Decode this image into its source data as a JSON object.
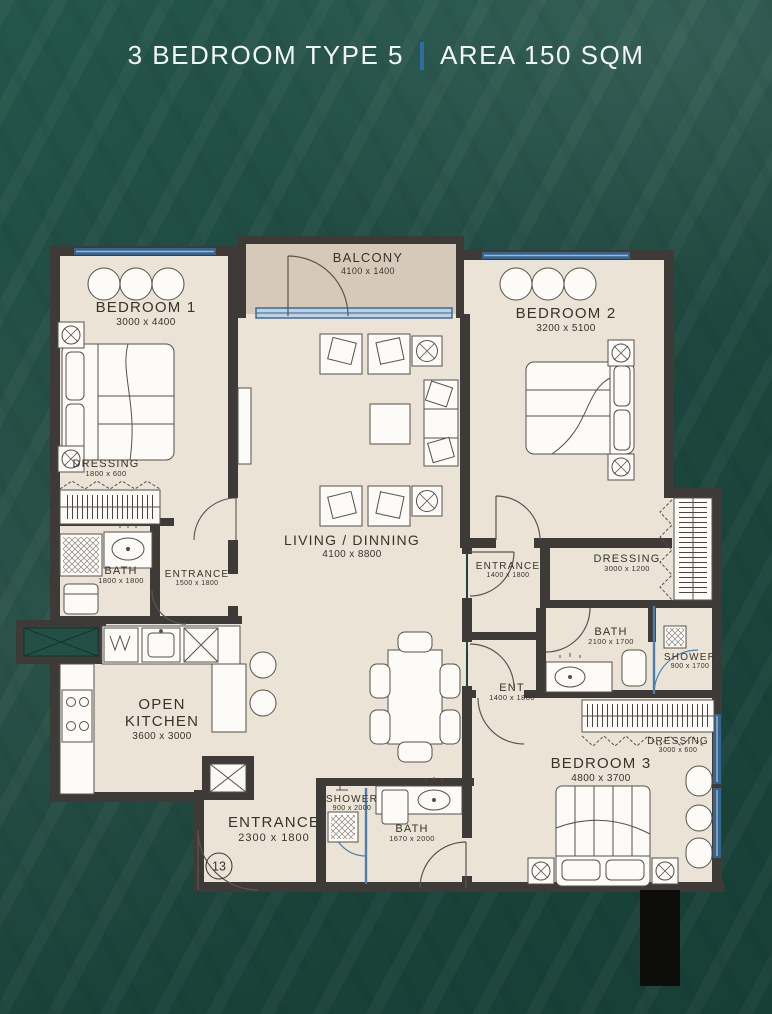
{
  "title": {
    "left": "3 BEDROOM TYPE 5",
    "divider": "|",
    "right": "AREA 150 SQM"
  },
  "unit_number": "13",
  "colors": {
    "background_green": "#1e483f",
    "title_text": "#f3f5f4",
    "title_divider_blue": "#2e6d9c",
    "floor_beige": "#ebe3d5",
    "balcony_floor": "#d7c9ba",
    "wall_dark": "#3e3a37",
    "window_blue": "#35648e",
    "glass_blue": "#4d7fae",
    "label_text": "#38332d",
    "shaft_black": "#0d0d0c"
  },
  "rooms": {
    "balcony": {
      "name": "BALCONY",
      "dims": "4100 x 1400"
    },
    "bedroom1": {
      "name": "BEDROOM 1",
      "dims": "3000 x 4400"
    },
    "bedroom2": {
      "name": "BEDROOM 2",
      "dims": "3200 x 5100"
    },
    "living": {
      "name": "LIVING / DINNING",
      "dims": "4100 x 8800"
    },
    "dressing1": {
      "name": "DRESSING",
      "dims": "1800 x 600"
    },
    "bath1": {
      "name": "BATH",
      "dims": "1800 x 1800"
    },
    "entrance1": {
      "name": "ENTRANCE",
      "dims": "1500 x 1800"
    },
    "kitchen": {
      "name": "OPEN KITCHEN",
      "dims": "3600 x 3000"
    },
    "entrance_main": {
      "name": "ENTRANCE",
      "dims": "2300 x 1800"
    },
    "shower_main": {
      "name": "SHOWER",
      "dims": "900 x 2000"
    },
    "bath_main": {
      "name": "BATH",
      "dims": "1670 x 2000"
    },
    "entrance2": {
      "name": "ENTRANCE",
      "dims": "1400 x 1800"
    },
    "ent": {
      "name": "ENT",
      "dims": "1400 x 1800"
    },
    "dressing2": {
      "name": "DRESSING",
      "dims": "3000 x 1200"
    },
    "bath2": {
      "name": "BATH",
      "dims": "2100 x 1700"
    },
    "shower2": {
      "name": "SHOWER",
      "dims": "900 x 1700"
    },
    "dressing3": {
      "name": "DRESSING",
      "dims": "3000 x 600"
    },
    "bedroom3": {
      "name": "BEDROOM 3",
      "dims": "4800 x 3700"
    }
  }
}
